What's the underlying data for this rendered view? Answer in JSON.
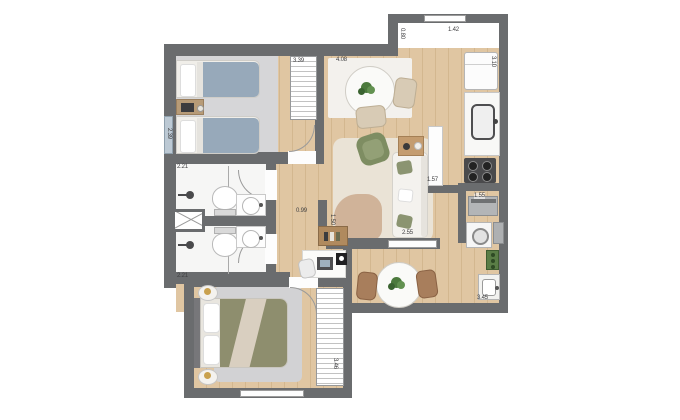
{
  "plan_title": "apartment-floor-plan",
  "measurements": {
    "bedroom1_height": "2.39",
    "bathroom_top_width": "2.21",
    "bathroom_bottom_width": "2.21",
    "bedroom1_width": "3.39",
    "dining_width": "4.08",
    "entry_step_height": "0.80",
    "kitchen_top_width": "1.42",
    "kitchen_column_height": "3.10",
    "laundry_width": "1.55",
    "hallway_width": "0.99",
    "hallway_wall": "1.50",
    "service_corridor_width": "1.57",
    "living_width": "2.55",
    "laundry_bottom_width": "3.45",
    "bedroom2_width": "3.46"
  },
  "colors": {
    "wall": "#6a6c6e",
    "wood_floor": "#e0c6a2",
    "carpet": "#d6d6d8",
    "olive_bed": "#8e8e6e",
    "blue_blanket": "#97a9ba",
    "green_armchair": "#7e8d62",
    "plant_green": "#4c7a3d"
  }
}
